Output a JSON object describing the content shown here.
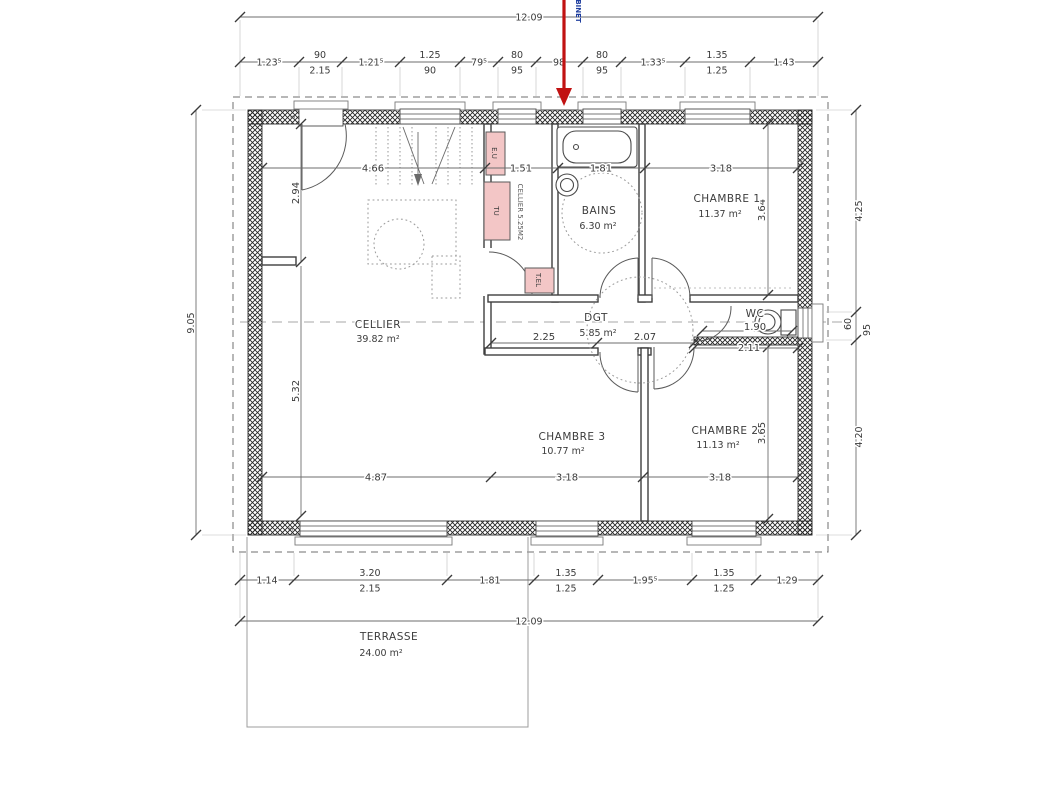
{
  "annotation": {
    "label": "ROBINET"
  },
  "rooms": {
    "cellier": {
      "name": "CELLIER",
      "area": "39.82 m²"
    },
    "closet": {
      "name": "CELLIER 5.25M2"
    },
    "bains": {
      "name": "BAINS",
      "area": "6.30 m²"
    },
    "chambre1": {
      "name": "CHAMBRE 1",
      "area": "11.37 m²"
    },
    "chambre2": {
      "name": "CHAMBRE 2",
      "area": "11.13 m²"
    },
    "chambre3": {
      "name": "CHAMBRE 3",
      "area": "10.77 m²"
    },
    "dgt": {
      "name": "DGT",
      "area": "5.85 m²"
    },
    "wc": {
      "name": "WC"
    },
    "terrasse": {
      "name": "TERRASSE",
      "area": "24.00 m²"
    }
  },
  "fixtures": {
    "eu": "E.U",
    "tu": "TU",
    "tel": "T.EL"
  },
  "dims": {
    "overall_top": "12.09",
    "overall_bottom": "12.09",
    "overall_left": "9.05",
    "top_chain": [
      {
        "a": "1.23⁵"
      },
      {
        "a": "90",
        "b": "2.15"
      },
      {
        "a": "1.21⁵"
      },
      {
        "a": "1.25",
        "b": "90"
      },
      {
        "a": "79⁵"
      },
      {
        "a": "80",
        "b": "95"
      },
      {
        "a": "98"
      },
      {
        "a": "80",
        "b": "95"
      },
      {
        "a": "1.33⁵"
      },
      {
        "a": "1.35",
        "b": "1.25"
      },
      {
        "a": "1.43"
      }
    ],
    "bottom_chain": [
      {
        "a": "1.14"
      },
      {
        "a": "3.20",
        "b": "2.15"
      },
      {
        "a": "1.81"
      },
      {
        "a": "1.35",
        "b": "1.25"
      },
      {
        "a": "1.95⁵"
      },
      {
        "a": "1.35",
        "b": "1.25"
      },
      {
        "a": "1.29"
      }
    ],
    "right_chain": [
      {
        "a": "4.25"
      },
      {
        "a": "60",
        "b": "95"
      },
      {
        "a": "4.20"
      }
    ],
    "int_top": [
      "4.66",
      "1.51",
      "1.81",
      "3.18"
    ],
    "int_bottom": [
      "4.87",
      "3.18",
      "3.18"
    ],
    "vert": [
      "2.94",
      "5.32",
      "3.64",
      "3.65"
    ],
    "dgt": [
      "2.25",
      "2.07"
    ],
    "wc": [
      "1.90",
      "2.11"
    ],
    "marks": [
      "6",
      "3",
      "3",
      "6",
      "6",
      "3"
    ]
  },
  "colors": {
    "arrow": "#c11212",
    "annotation_blue": "#1f3e9e",
    "fixture_pink": "#f3c6c6"
  }
}
